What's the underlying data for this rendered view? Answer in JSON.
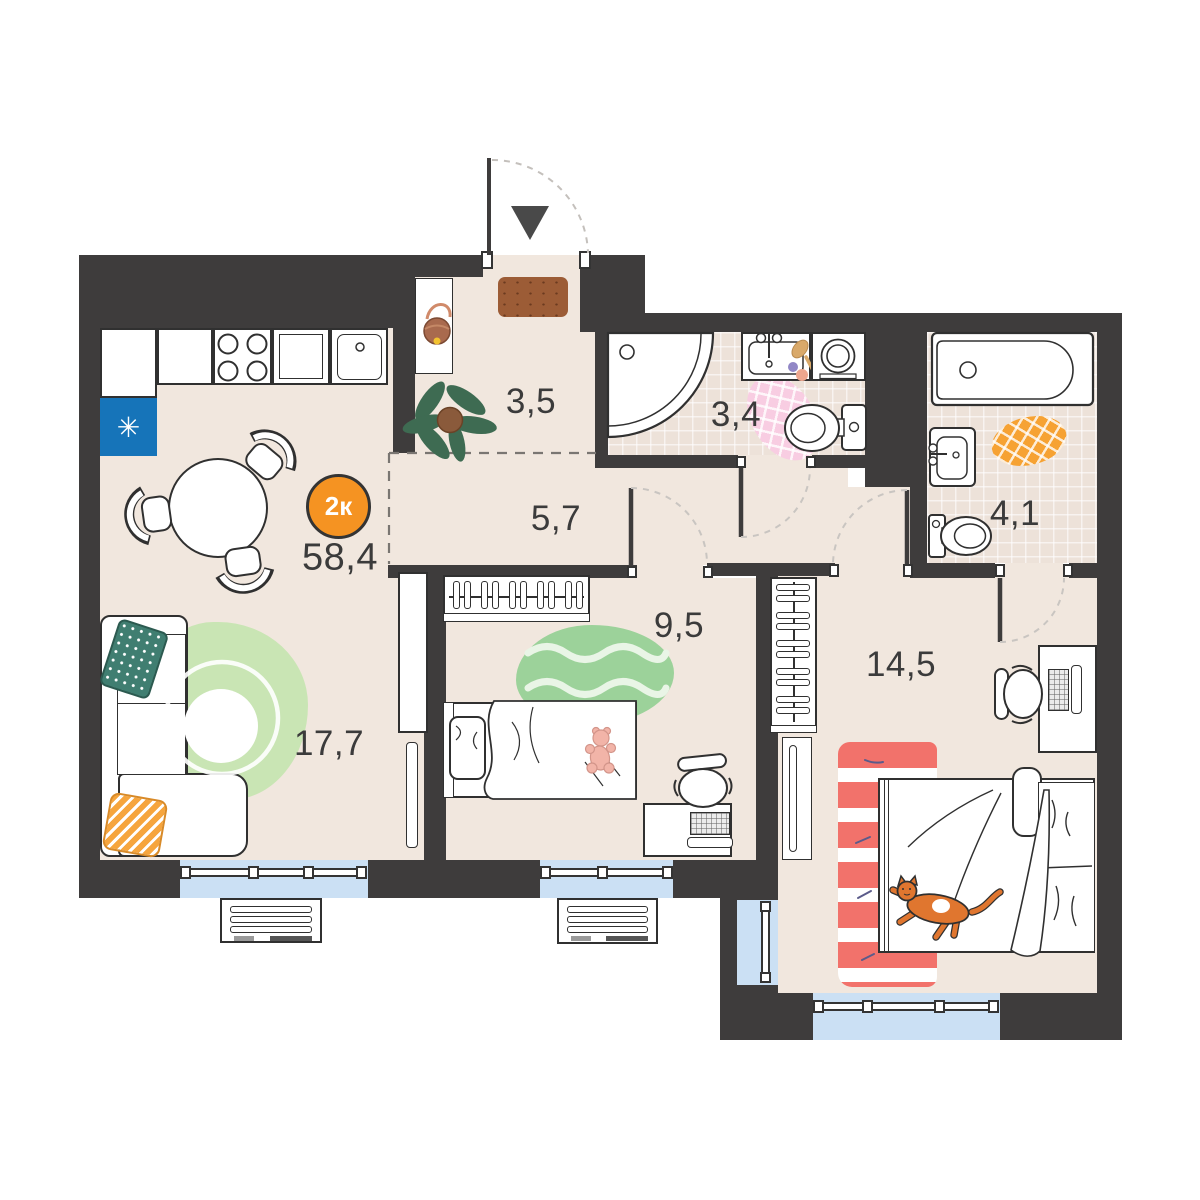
{
  "plan": {
    "badge": {
      "label": "2к",
      "total_area": "58,4"
    },
    "rooms": {
      "kitchen_living": {
        "area": "17,7"
      },
      "hallway": {
        "area": "3,5"
      },
      "corridor": {
        "area": "5,7"
      },
      "bathroom": {
        "area": "3,4"
      },
      "ensuite_bathroom": {
        "area": "4,1"
      },
      "bedroom": {
        "area": "9,5"
      },
      "master_bedroom": {
        "area": "14,5"
      }
    },
    "kitchen": {
      "fridge_mark": "✳"
    },
    "colors": {
      "wall": "#3E3C3C",
      "floor": "#F1E7DE",
      "tile_floor": "#EDE2D9",
      "window": "#CBE0F4",
      "badge": "#F59322",
      "fridge": "#1674B9",
      "rug_green_living": "#C9E5B4",
      "rug_green_bedroom": "#9CD29A",
      "rug_pink": "#F8CDE2",
      "rug_orange": "#F6A233",
      "rug_red": "#F2726B",
      "pillow_teal": "#407E71",
      "pillow_orange": "#F6A53D",
      "doormat": "#9C5C36",
      "cat": "#E0762F",
      "label_text": "#3B3B3B"
    }
  }
}
